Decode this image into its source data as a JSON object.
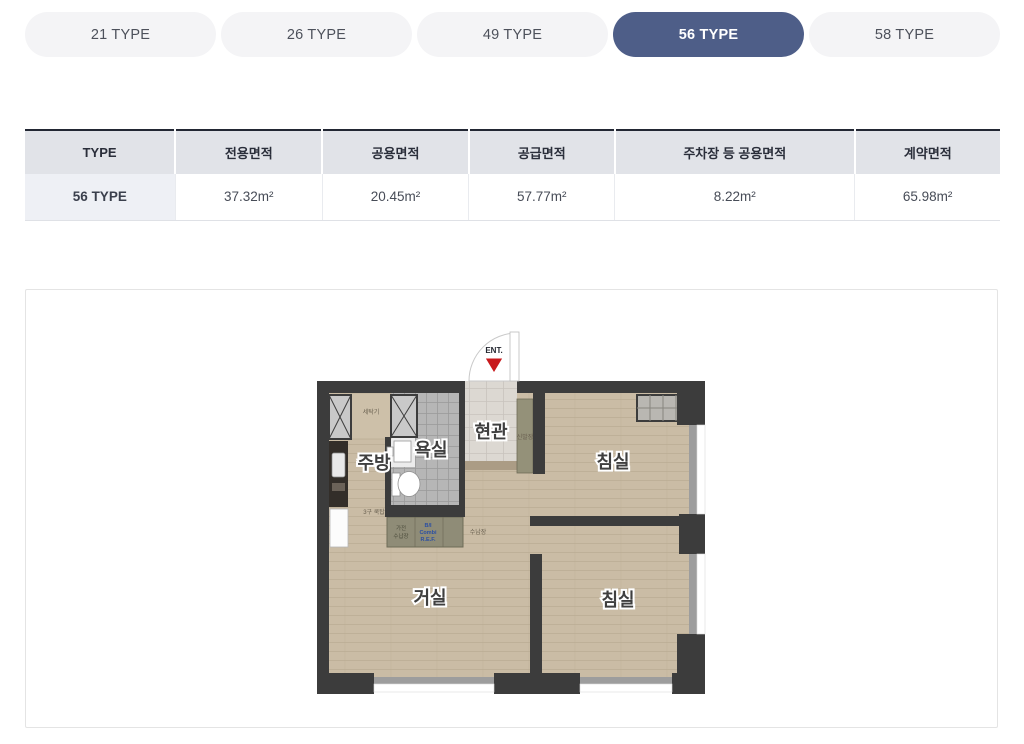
{
  "tabs": [
    {
      "label": "21 TYPE",
      "active": false
    },
    {
      "label": "26 TYPE",
      "active": false
    },
    {
      "label": "49 TYPE",
      "active": false
    },
    {
      "label": "56 TYPE",
      "active": true
    },
    {
      "label": "58 TYPE",
      "active": false
    }
  ],
  "table": {
    "headers": [
      "TYPE",
      "전용면적",
      "공용면적",
      "공급면적",
      "주차장 등 공용면적",
      "계약면적"
    ],
    "rows": [
      [
        "56 TYPE",
        "37.32m²",
        "20.45m²",
        "57.77m²",
        "8.22m²",
        "65.98m²"
      ]
    ]
  },
  "floorplan": {
    "entrance_marker": "ENT.",
    "rooms": {
      "kitchen": "주방",
      "bathroom": "욕실",
      "entrance": "현관",
      "bedroom1": "침실",
      "living": "거실",
      "bedroom2": "침실"
    },
    "labels": {
      "washer": "세탁기",
      "cooktop": "3구 쿡탑",
      "appliance_cab_1": "가전",
      "appliance_cab_2": "수납장",
      "ref_1": "B/I",
      "ref_2": "Combi",
      "ref_3": "R.E.F.",
      "storage": "수납장",
      "shoe_cabinet": "신발장"
    },
    "colors": {
      "wall": "#3c3c3c",
      "floor": "#cabca5",
      "accent_red": "#c8191c",
      "ref_blue": "#2b4fa2",
      "active_tab": "#4e5e88"
    }
  }
}
